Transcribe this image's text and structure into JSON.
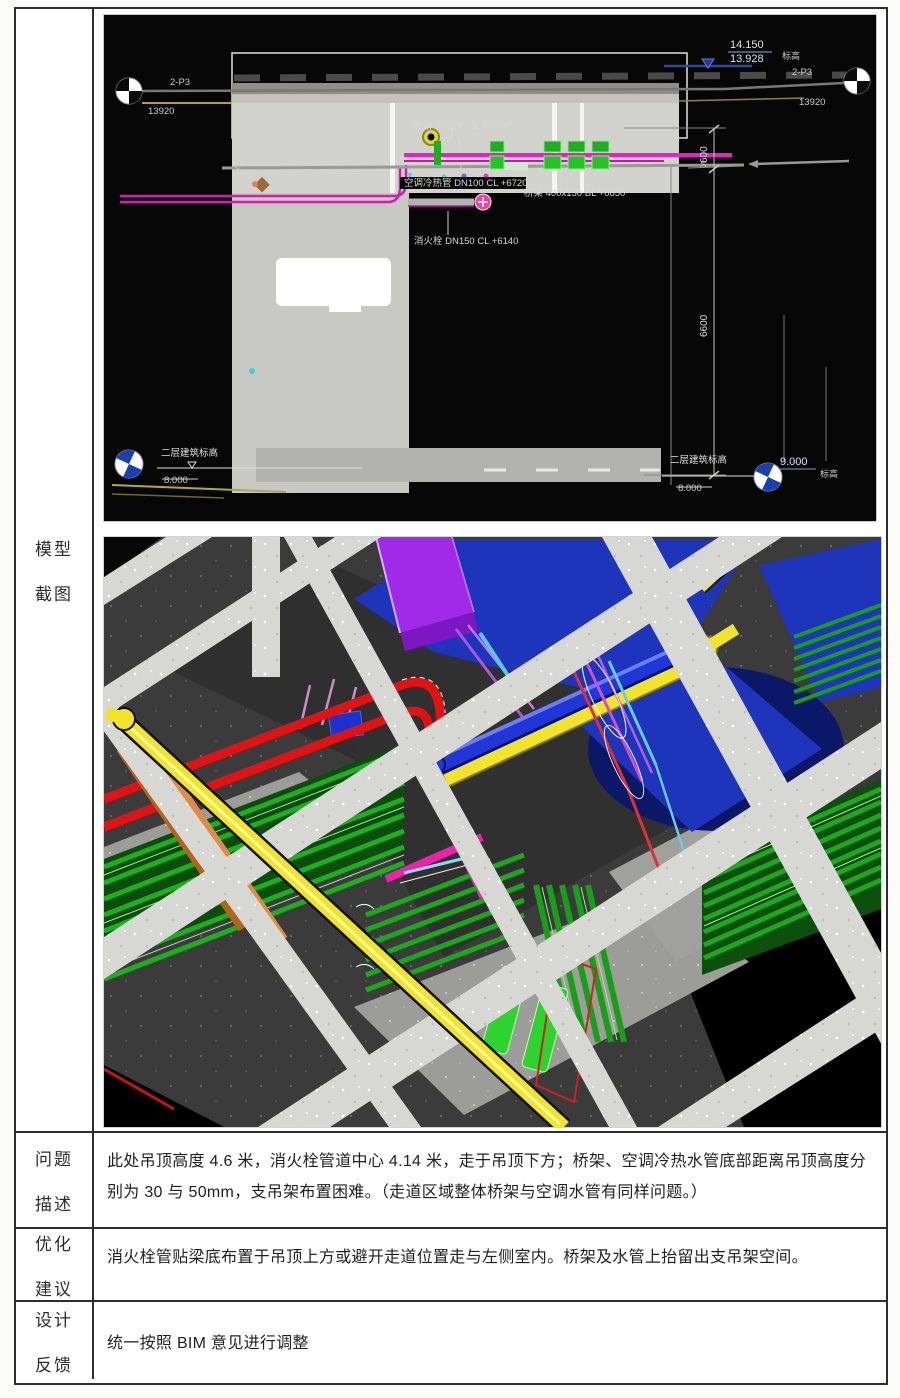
{
  "document": {
    "rows": [
      {
        "label1": "模型",
        "label2": "截图"
      },
      {
        "label1": "问题",
        "label2": "描述",
        "text": "此处吊顶高度 4.6 米，消火栓管道中心 4.14 米，走于吊顶下方；桥架、空调冷热水管底部距离吊顶高度分别为 30 与 50mm，支吊架布置困难。（走道区域整体桥架与空调水管有同样问题。）"
      },
      {
        "label1": "优化",
        "label2": "建议",
        "text": "消火栓管贴梁底布置于吊顶上方或避开走道位置走与左侧室内。桥架及水管上抬留出支吊架空间。"
      },
      {
        "label1": "设计",
        "label2": "反馈",
        "text": "统一按照 BIM 意见进行调整"
      }
    ]
  },
  "cad": {
    "axis_left": "2-P3",
    "axis_left_dim": "13920",
    "axis_right": "2-P3",
    "axis_right_dim": "13920",
    "level_top_1": "14.150",
    "level_top_2": "13.928",
    "level_top_side": "标高",
    "label_sprinkler": "喷淋 DN100 CL +6840",
    "label_hvac": "空调冷热管 DN100 CL +6720",
    "label_tray": "桥架 400x150 BL +6650",
    "label_hydrant": "消火栓 DN150 CL +6140",
    "dim_a": "600",
    "dim_b": "6600",
    "break_mark": "S",
    "level_bl_label": "二层建筑标高",
    "level_bl_value": "8.000",
    "level_br_label": "二层建筑标高",
    "level_br_value": "8.000",
    "level_br_value2": "9.000",
    "level_br_side": "标高"
  },
  "model": {
    "colors": {
      "beam_gray": "#d7d7d3",
      "wall_dark": "#2f2f2f",
      "slab_blue": "#1e34bb",
      "duct_purple": "#a02ae8",
      "pipe_yellow": "#f2e42a",
      "pipe_blue": "#2136d6",
      "tray_green": "#1cb01c",
      "pipe_red": "#e21212",
      "pipe_orange": "#e08c46",
      "pipe_magenta": "#ee22aa",
      "pipe_cyan": "#66ccee"
    }
  }
}
